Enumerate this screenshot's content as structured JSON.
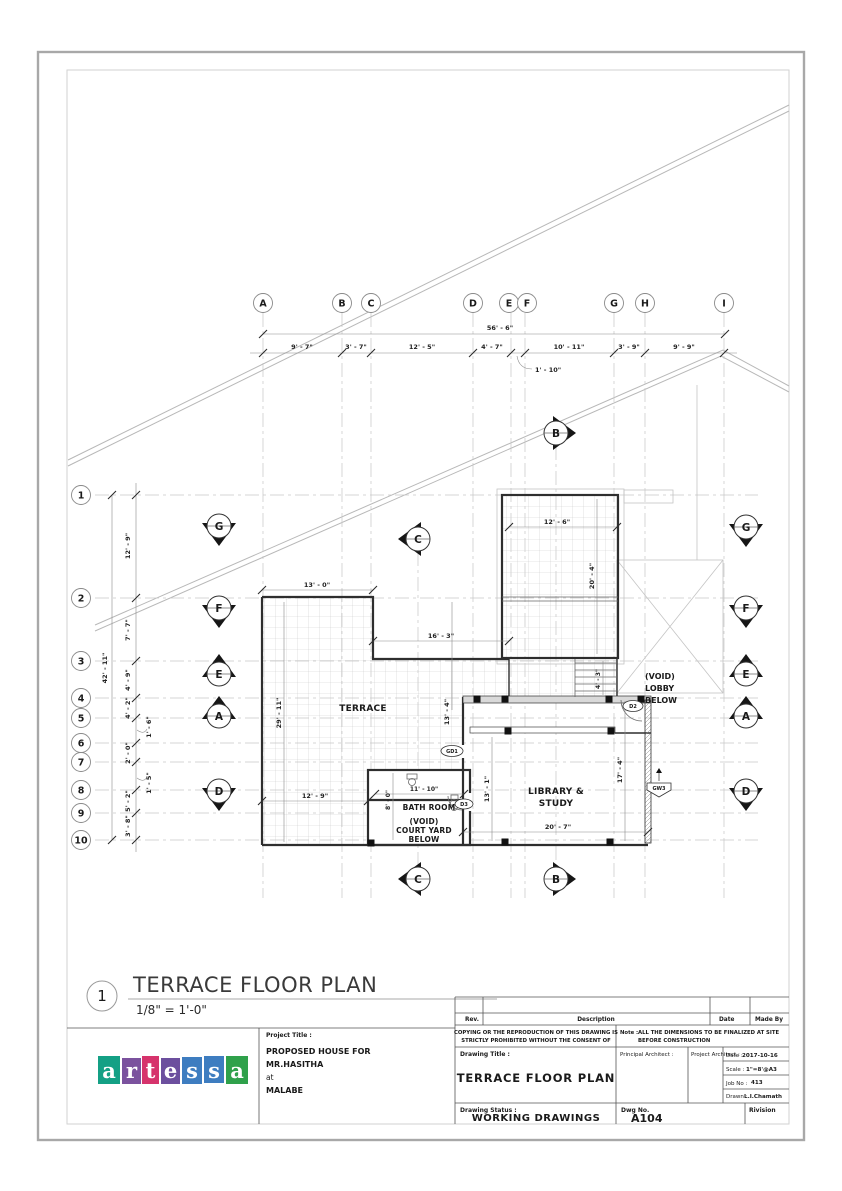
{
  "view": {
    "number": "1",
    "title": "TERRACE FLOOR PLAN",
    "scale": "1/8\" = 1'-0\""
  },
  "grid": {
    "columns": [
      "A",
      "B",
      "C",
      "D",
      "E",
      "F",
      "G",
      "H",
      "I"
    ],
    "rows": [
      "1",
      "2",
      "3",
      "4",
      "5",
      "6",
      "7",
      "8",
      "9",
      "10"
    ]
  },
  "dims": {
    "top_overall": "56' - 6\"",
    "top_segments": [
      "9' - 7\"",
      "3' - 7\"",
      "12' - 5\"",
      "4' - 7\"",
      "10' - 11\"",
      "3' - 9\"",
      "9' - 9\""
    ],
    "top_offset": "1' - 10\"",
    "left_overall": "42' - 11\"",
    "left_segments": [
      "12' - 9\"",
      "7' - 7\"",
      "4' - 9\"",
      "4' - 2\"",
      "2' - 0\"",
      "5' - 2\"",
      "3' - 8\""
    ],
    "left_offsets": [
      "1' - 6\"",
      "1' - 5\""
    ]
  },
  "plan": {
    "rooms": {
      "terrace": "TERRACE",
      "bath": "BATH ROOM",
      "court": [
        "(VOID)",
        "COURT YARD",
        "BELOW"
      ],
      "library": [
        "LIBRARY &",
        "STUDY"
      ],
      "lobby": [
        "(VOID)",
        "LOBBY",
        "BELOW"
      ]
    },
    "interior_dims": {
      "d13_0": "13' - 0\"",
      "d16_3": "16' - 3\"",
      "d12_6": "12' - 6\"",
      "d20_4": "20' - 4\"",
      "d29_11": "29' - 11\"",
      "d13_4": "13' - 4\"",
      "d12_9": "12' - 9\"",
      "d11_10": "11' - 10\"",
      "d8_0": "8' - 0\"",
      "d13_1": "13' - 1\"",
      "d17_4": "17' - 4\"",
      "d20_7": "20' - 7\"",
      "d4_3": "4' - 3\""
    },
    "tags": {
      "gd1": "GD1",
      "d2": "D2",
      "d3": "D3",
      "gw3": "GW3"
    }
  },
  "markers": {
    "b": "B",
    "c": "C",
    "left": [
      "G",
      "F",
      "E",
      "A",
      "D"
    ],
    "right": [
      "G",
      "F",
      "E",
      "A",
      "D"
    ]
  },
  "title_block": {
    "rev_header": {
      "rev": "Rev.",
      "description": "Description",
      "date": "Date",
      "made_by": "Made By"
    },
    "copyright": [
      "COPYING OR THE REPRODUCTION OF THIS DRAWING IS",
      "STRICTLY PROHIBITED WITHOUT THE CONSENT OF"
    ],
    "note_label": "Note :",
    "note": [
      "ALL THE DIMENSIONS TO BE FINALIZED AT SITE",
      "BEFORE CONSTRUCTION"
    ],
    "project_title_label": "Project Title :",
    "project_title": [
      "PROPOSED HOUSE FOR",
      "MR.HASITHA",
      "at",
      "MALABE"
    ],
    "drawing_title_label": "Drawing Title :",
    "drawing_title": "TERRACE FLOOR PLAN",
    "principal_architect_label": "Principal Architect :",
    "project_architect_label": "Project Architect :",
    "date_label": "Date :",
    "date": "2017-10-16",
    "scale_label": "Scale :",
    "scale": "1\"=8'@A3",
    "job_label": "Job No :",
    "job": "413",
    "drawn_label": "Drawn :",
    "drawn": "L.I.Chamath",
    "status_label": "Drawing Status :",
    "status": "WORKING DRAWINGS",
    "dwg_label": "Dwg No.",
    "dwg": "A104",
    "revision_label": "Rivision"
  },
  "logo": {
    "letters": [
      {
        "ch": "a",
        "bg": "#14A085"
      },
      {
        "ch": "r",
        "bg": "#7B529E"
      },
      {
        "ch": "t",
        "bg": "#D6336C"
      },
      {
        "ch": "e",
        "bg": "#6C4F9E"
      },
      {
        "ch": "s",
        "bg": "#3E7DC0"
      },
      {
        "ch": "s",
        "bg": "#3E7DC0"
      },
      {
        "ch": "a",
        "bg": "#2FA14B"
      }
    ]
  }
}
